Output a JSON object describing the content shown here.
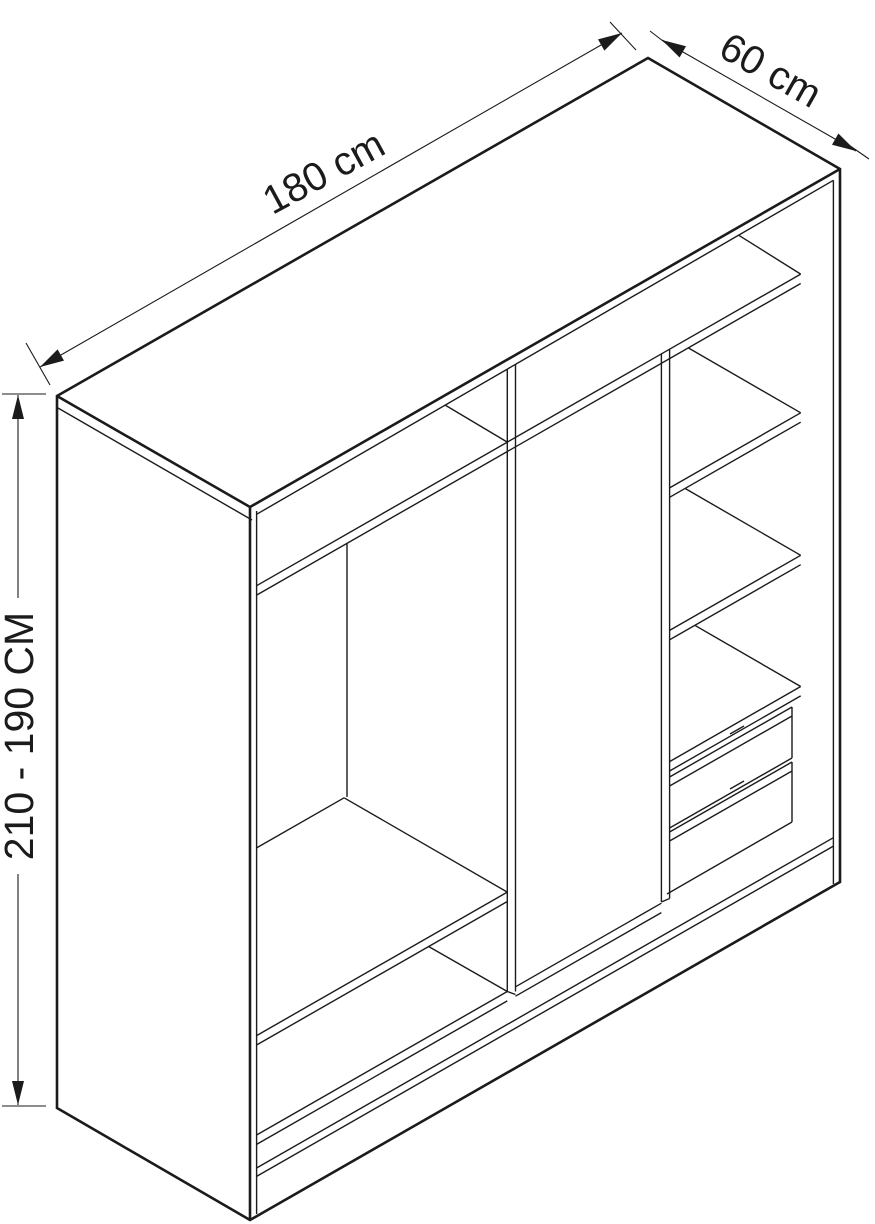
{
  "figure": {
    "kind": "wardrobe-interior-isometric-line-drawing"
  },
  "colors": {
    "line": "#1b1b1b",
    "background": "#ffffff"
  },
  "dimensions": {
    "width_label": "180 cm",
    "depth_label": "60 cm",
    "height_label": "210 - 190 CM"
  }
}
